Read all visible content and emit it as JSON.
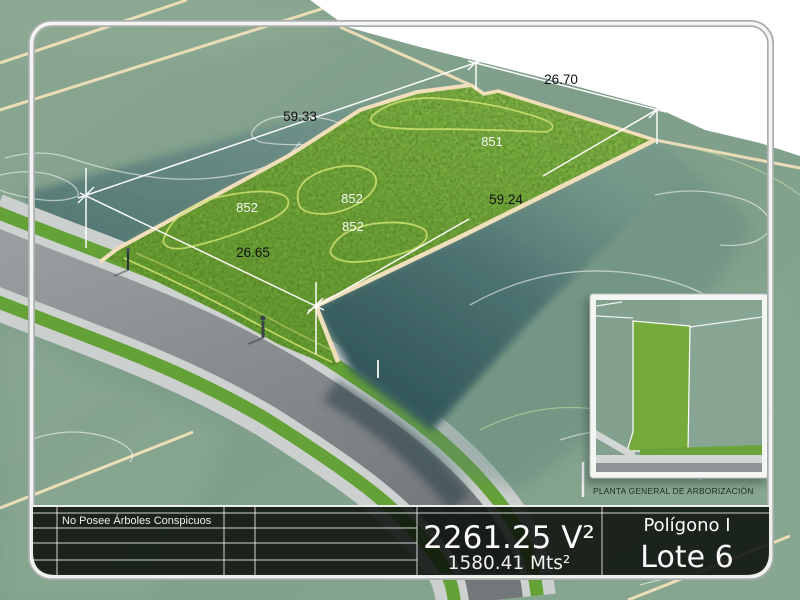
{
  "scene": {
    "dim_labels": {
      "top": "26.70",
      "left": "59.33",
      "right": "59.24",
      "bottom": "26.65"
    },
    "contour_labels": {
      "a": "851",
      "b": "852",
      "c": "852",
      "d": "852"
    },
    "inset_caption": "PLANTA GENERAL DE ARBORIZACIÓN"
  },
  "info_bar": {
    "note": "No Posee Árboles Conspicuos",
    "area_primary": "2261.25 V²",
    "area_secondary": "1580.41 Mts²",
    "zone": "Polígono I",
    "lot": "Lote 6"
  },
  "colors": {
    "sky": "#ffffff",
    "terrain_sage": "#80A08C",
    "teal_shadow": "#4F7472",
    "lot_green": "#74A73B",
    "cream_line": "#F0DFBA",
    "asphalt": "#94989A",
    "sidewalk": "#CFD3D2",
    "verge_green": "#64A136",
    "bar_background": "rgba(13,17,13,0.88)",
    "frame_white": "#F4F5F3"
  }
}
